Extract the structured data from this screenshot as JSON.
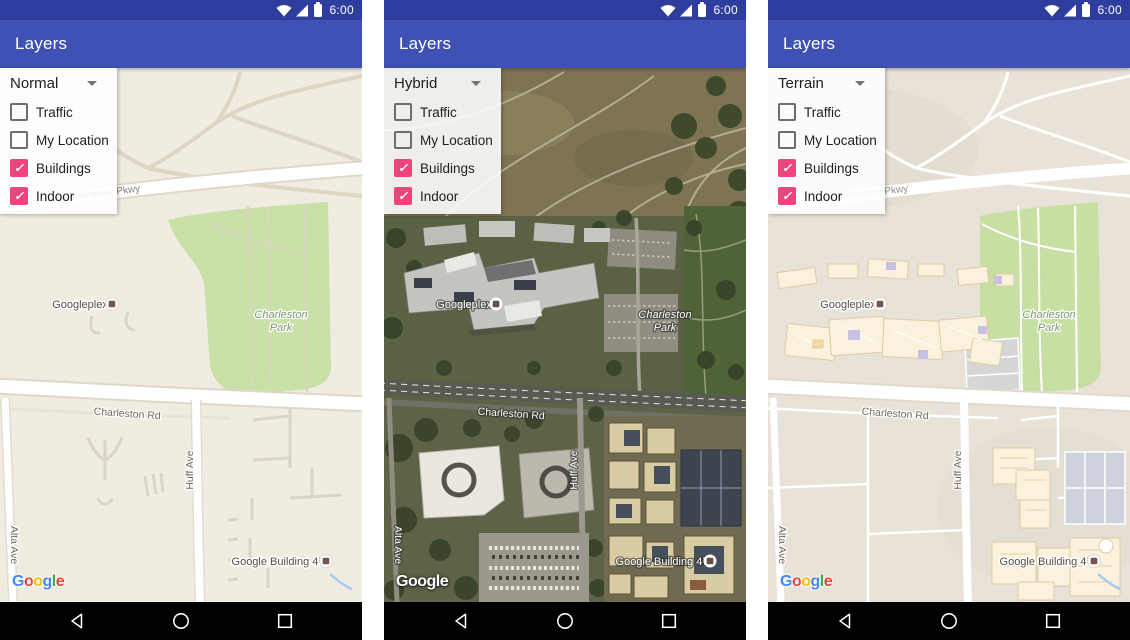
{
  "status_bar": {
    "time": "6:00"
  },
  "app_bar": {
    "title": "Layers"
  },
  "panel": {
    "items": [
      {
        "label": "Traffic",
        "checked": false
      },
      {
        "label": "My Location",
        "checked": false
      },
      {
        "label": "Buildings",
        "checked": true
      },
      {
        "label": "Indoor",
        "checked": true
      }
    ]
  },
  "phones": [
    {
      "map_type": "Normal"
    },
    {
      "map_type": "Hybrid"
    },
    {
      "map_type": "Terrain"
    }
  ],
  "icons": {
    "check": "✓"
  },
  "map_labels": {
    "poi": "Googleplex",
    "park_line1": "Charleston",
    "park_line2": "Park",
    "road": "Charleston Rd",
    "street_huff": "Huff Ave",
    "street_alta": "Alta Ave",
    "building": "Google Building 47",
    "pkwy_fragment": "Amphitheatre Pkwy"
  },
  "google_logo": {
    "text": "Google",
    "letters": [
      "G",
      "o",
      "o",
      "g",
      "l",
      "e"
    ],
    "colors": [
      "#4285F4",
      "#EA4335",
      "#FBBC05",
      "#4285F4",
      "#34A853",
      "#EA4335"
    ]
  },
  "colors": {
    "status_bar": "#2F3D9E",
    "app_bar": "#3F51B5",
    "accent_checkbox": "#F4437C",
    "map_normal_bg": "#F0ECE2",
    "map_terrain_bg": "#E9E2D8",
    "park_green": "#C9E0A6"
  }
}
